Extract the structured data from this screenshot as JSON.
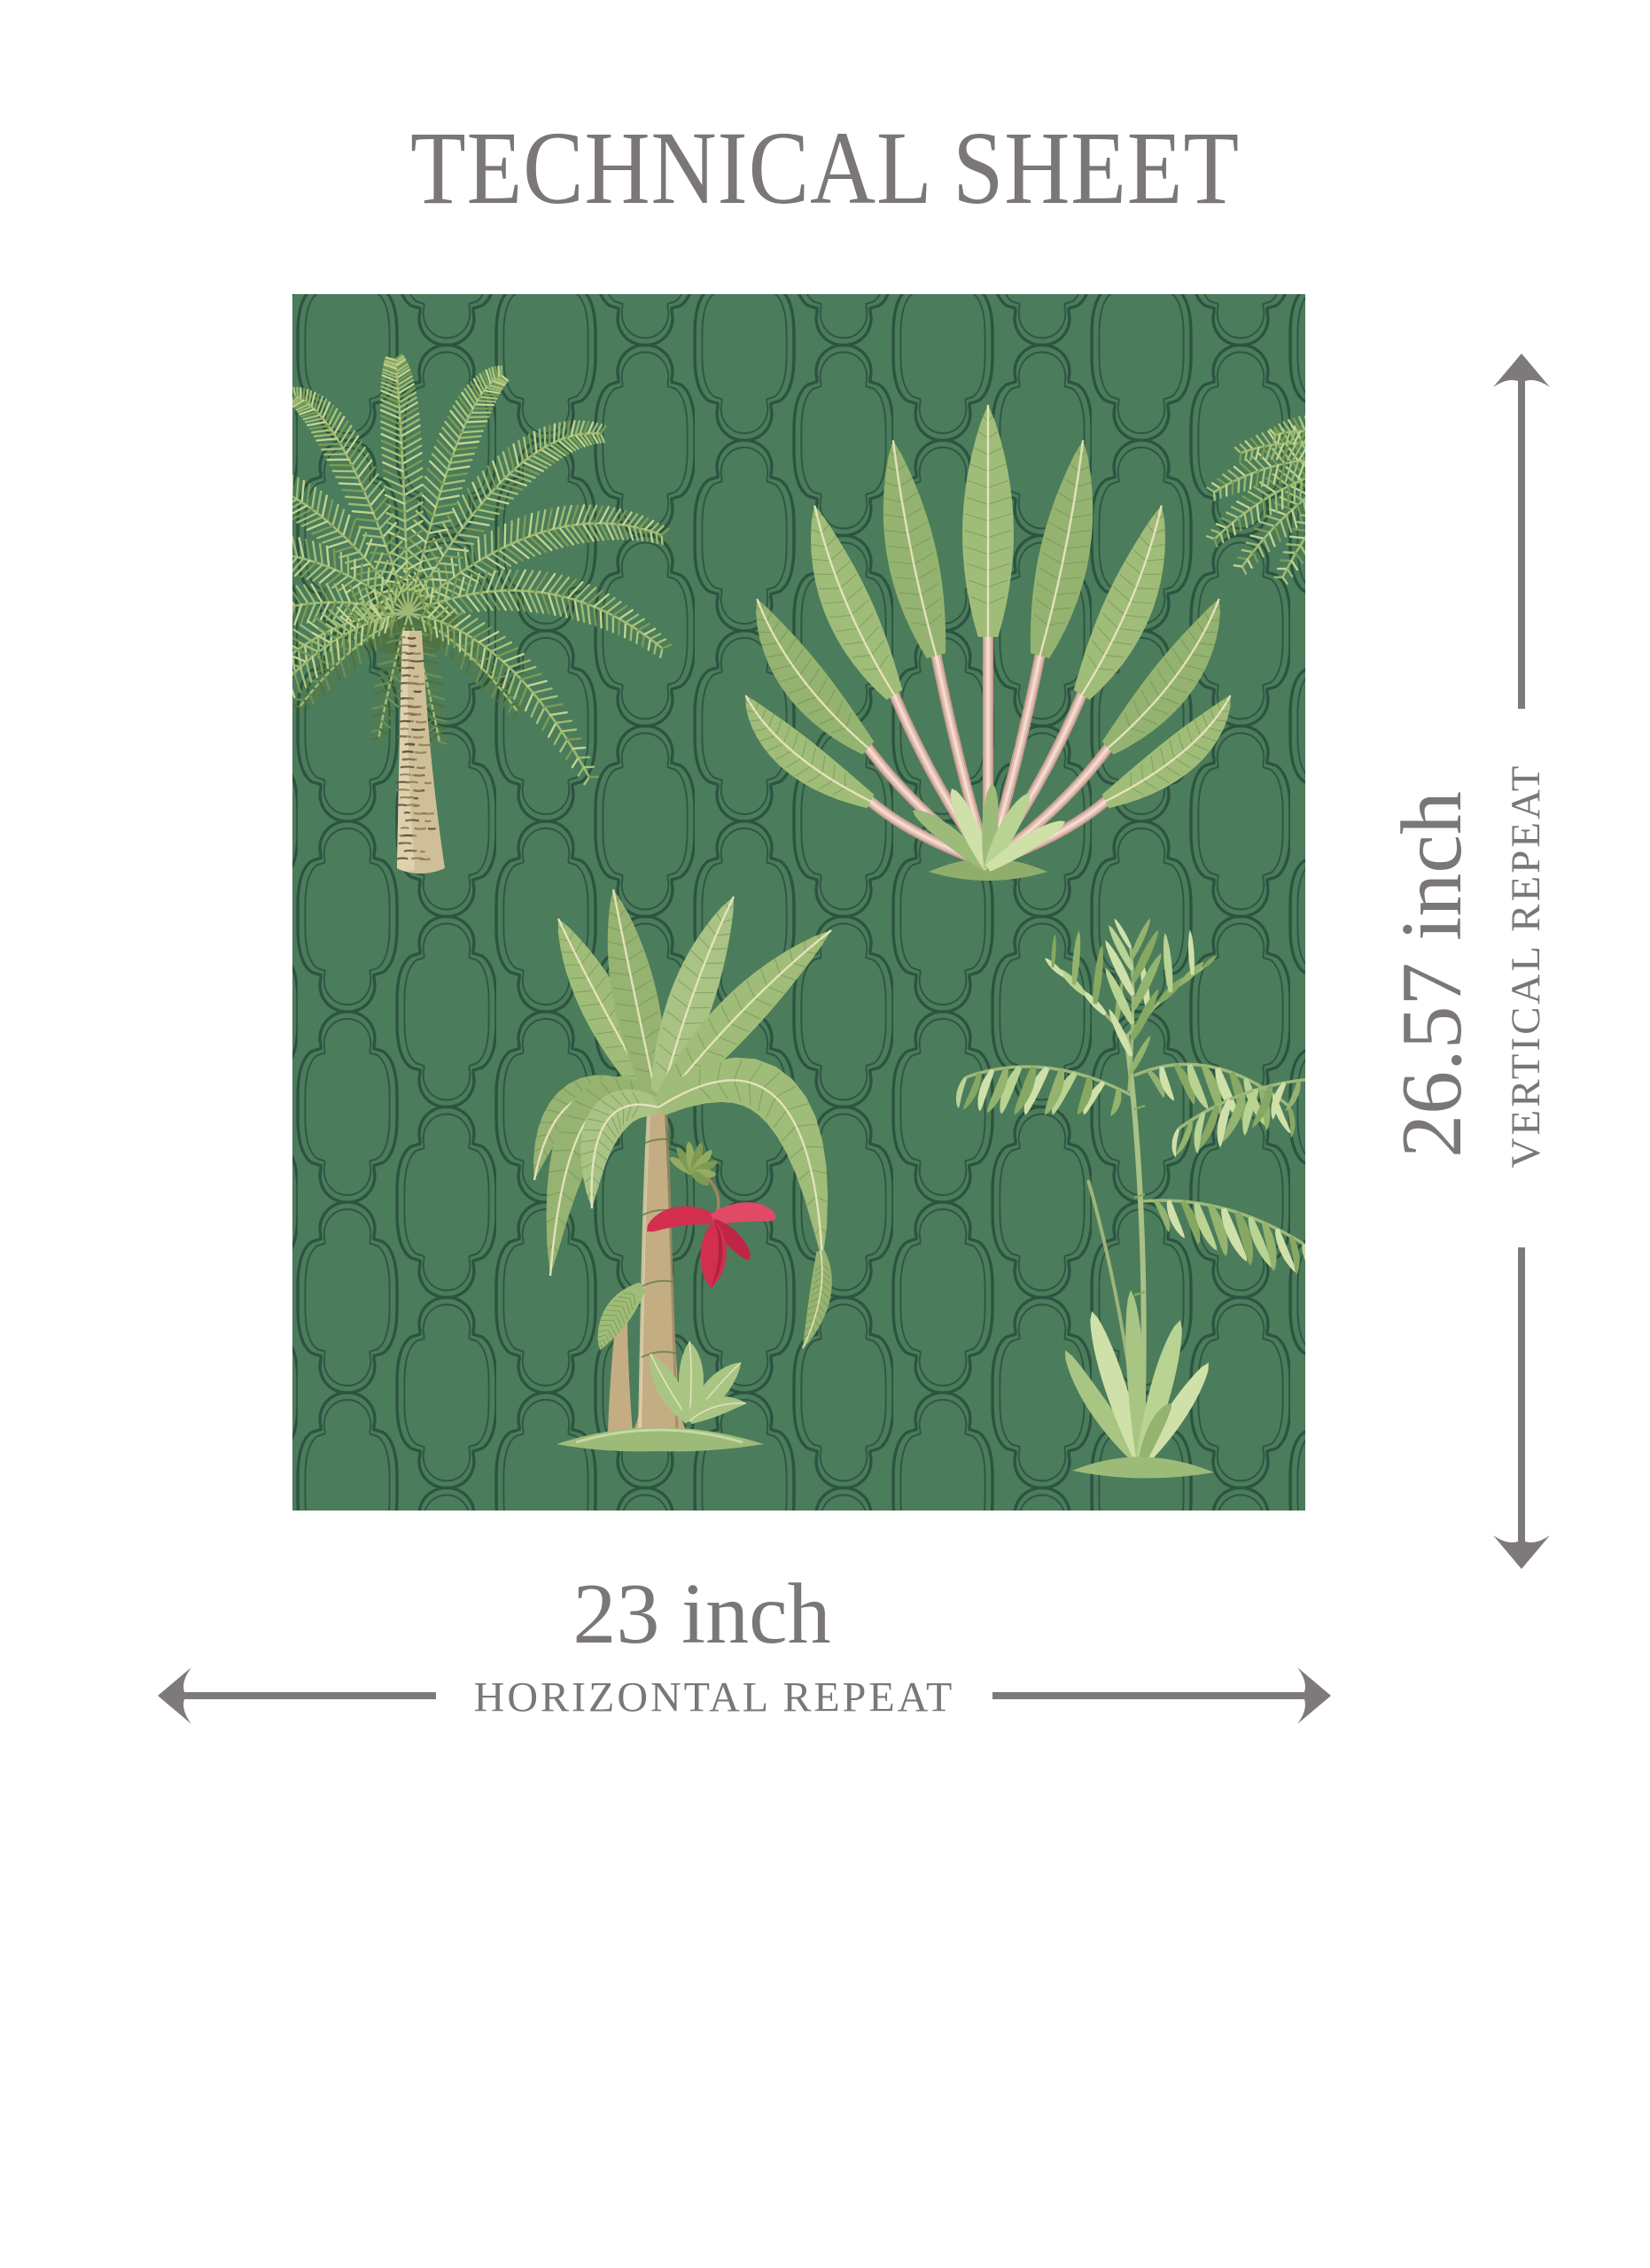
{
  "title": "TECHNICAL SHEET",
  "dimensions": {
    "vertical": {
      "value": "26.57 inch",
      "label": "VERTICAL REPEAT"
    },
    "horizontal": {
      "value": "23 inch",
      "label": "HORIZONTAL REPEAT"
    }
  },
  "swatch": {
    "alt": "Green tropical wallpaper repeat swatch with date palm, traveler's palm, flowering banana tree and areca palm over a dark green Moroccan quatrefoil trellis lattice",
    "motifs": [
      "date palm",
      "traveler's palm",
      "banana tree with red flower",
      "areca palm",
      "quatrefoil trellis lattice"
    ]
  },
  "colors": {
    "page_bg": "#ffffff",
    "text_gray": "#7b7677",
    "arrow_gray": "#7e7a7a",
    "swatch_bg": "#4b7c5b",
    "lattice_line": "#2c5440",
    "leaf_light": "#c3d48f",
    "leaf_mid": "#9cba74",
    "leaf_deep": "#7c9c55",
    "leaf_dark": "#5d7c40",
    "banana_leaf": "#a0bc79",
    "leaf_rib": "#6b8a4c",
    "midrib_cream": "#ece5c3",
    "trunk_tan": "#cfbf98",
    "trunk_shadow": "#8d7a52",
    "stem_pink": "#e3beb3",
    "stem_pink_light": "#f4ddd3",
    "flower_red": "#d22f4e",
    "grass_green": "#9cbb79",
    "grass_pale": "#cfe0a8"
  }
}
